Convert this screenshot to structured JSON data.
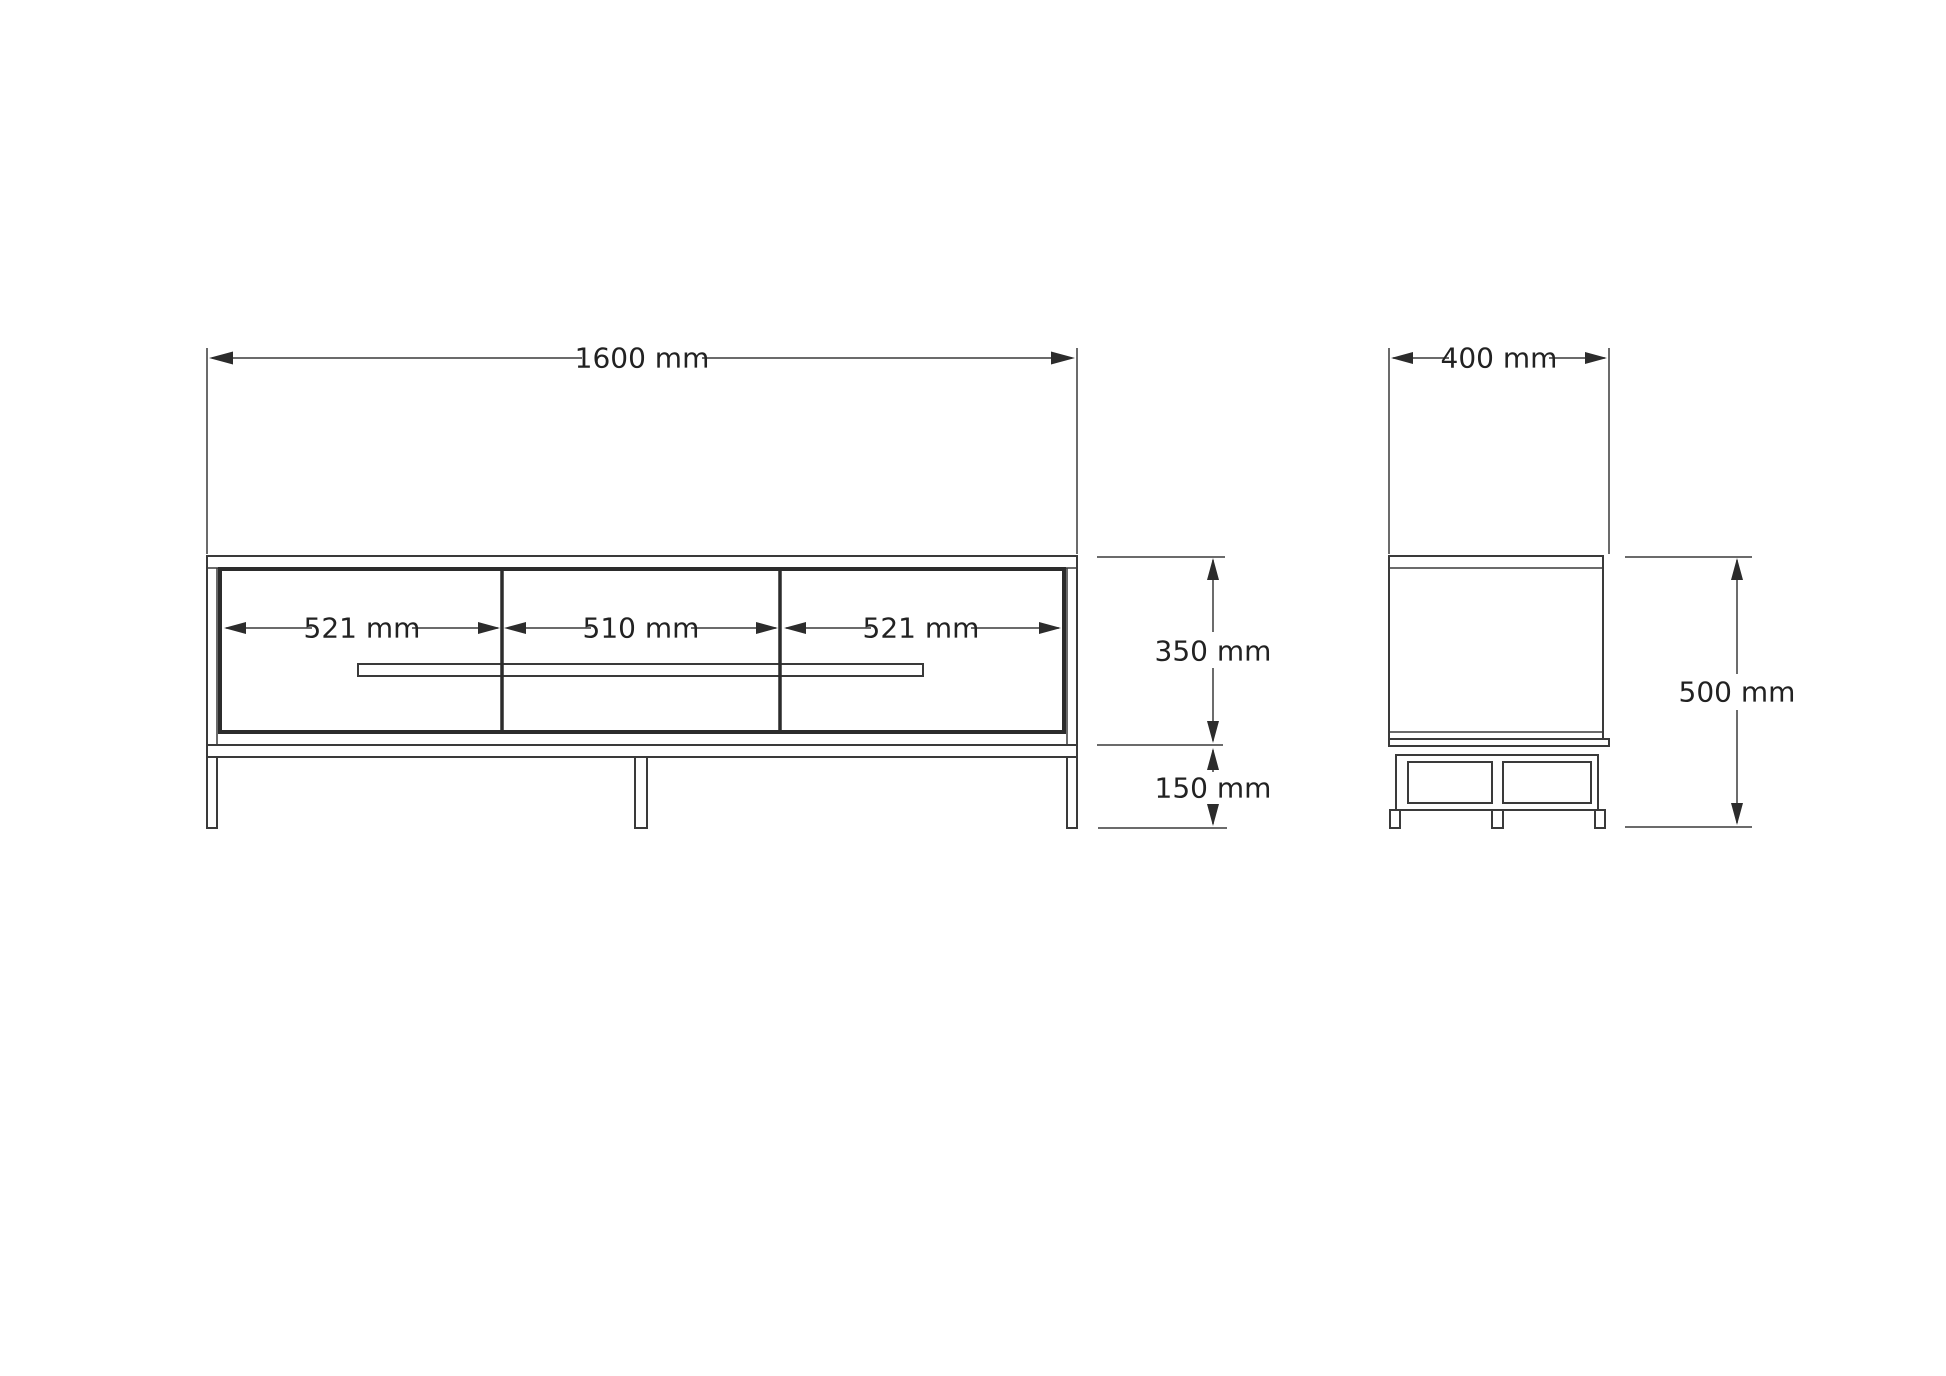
{
  "colors": {
    "background": "#ffffff",
    "line": "#3a3a3a",
    "dark_edge": "#2c2c2c",
    "text": "#222222"
  },
  "front_view": {
    "overall_width": {
      "label": "1600 mm",
      "mm": 1600
    },
    "sections": [
      {
        "label": "521 mm",
        "mm": 521
      },
      {
        "label": "510 mm",
        "mm": 510
      },
      {
        "label": "521 mm",
        "mm": 521
      }
    ],
    "carcass_height": {
      "label": "350 mm",
      "mm": 350
    },
    "base_height": {
      "label": "150 mm",
      "mm": 150
    }
  },
  "side_view": {
    "depth": {
      "label": "400 mm",
      "mm": 400
    },
    "overall_height": {
      "label": "500 mm",
      "mm": 500
    }
  }
}
